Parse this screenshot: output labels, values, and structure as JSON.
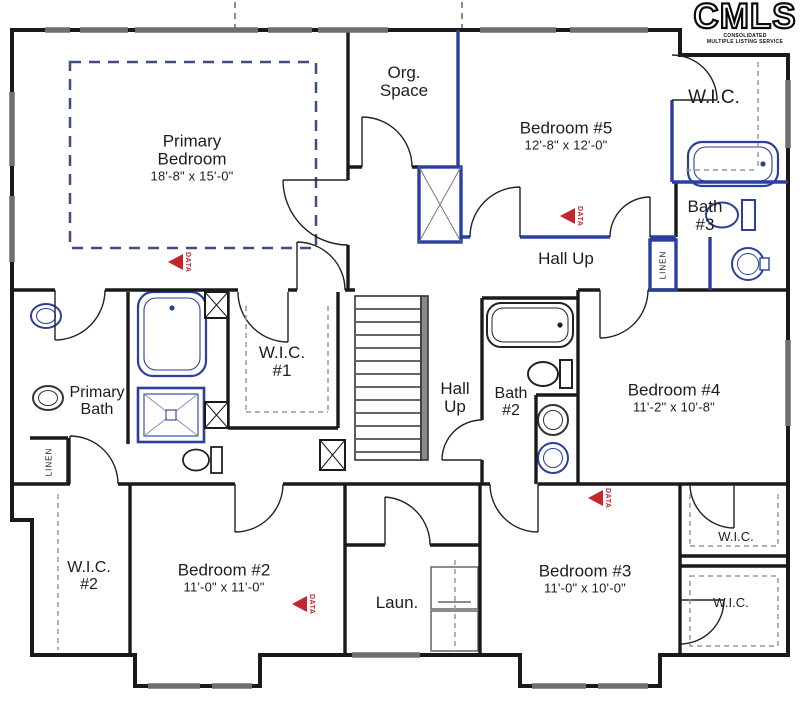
{
  "logo": {
    "name": "CMLS",
    "subtitle_line1": "CONSOLIDATED",
    "subtitle_line2": "MULTIPLE LISTING SERVICE"
  },
  "marker": {
    "label": "DATA"
  },
  "colors": {
    "wall": "#1a1a1a",
    "accent_blue": "#2b3f9e",
    "marker_red": "#c1272d",
    "window_gray": "#6f6f6f",
    "tray_ceiling_dash": "#3e4e7e"
  },
  "rooms": {
    "primary_bedroom": {
      "name": "Primary Bedroom",
      "dims": "18'-8\" x 15'-0\""
    },
    "org_space": {
      "name": "Org. Space"
    },
    "bedroom_5": {
      "name": "Bedroom #5",
      "dims": "12'-8\" x 12'-0\""
    },
    "wic_top_right": {
      "name": "W.I.C."
    },
    "bath_3": {
      "name": "Bath #3"
    },
    "hall_up_right": {
      "name": "Hall Up"
    },
    "linen_right": {
      "name": "LINEN"
    },
    "primary_bath": {
      "name": "Primary Bath"
    },
    "wic_1": {
      "name": "W.I.C. #1"
    },
    "hall_up_center": {
      "name": "Hall Up"
    },
    "bath_2": {
      "name": "Bath #2"
    },
    "bedroom_4": {
      "name": "Bedroom #4",
      "dims": "11'-2\" x 10'-8\""
    },
    "linen_left": {
      "name": "LINEN"
    },
    "wic_2": {
      "name": "W.I.C. #2"
    },
    "bedroom_2": {
      "name": "Bedroom #2",
      "dims": "11'-0\" x 11'-0\""
    },
    "laundry": {
      "name": "Laun."
    },
    "bedroom_3": {
      "name": "Bedroom #3",
      "dims": "11'-0\" x 10'-0\""
    },
    "wic_mid_right": {
      "name": "W.I.C."
    },
    "wic_bottom_right": {
      "name": "W.I.C."
    }
  }
}
